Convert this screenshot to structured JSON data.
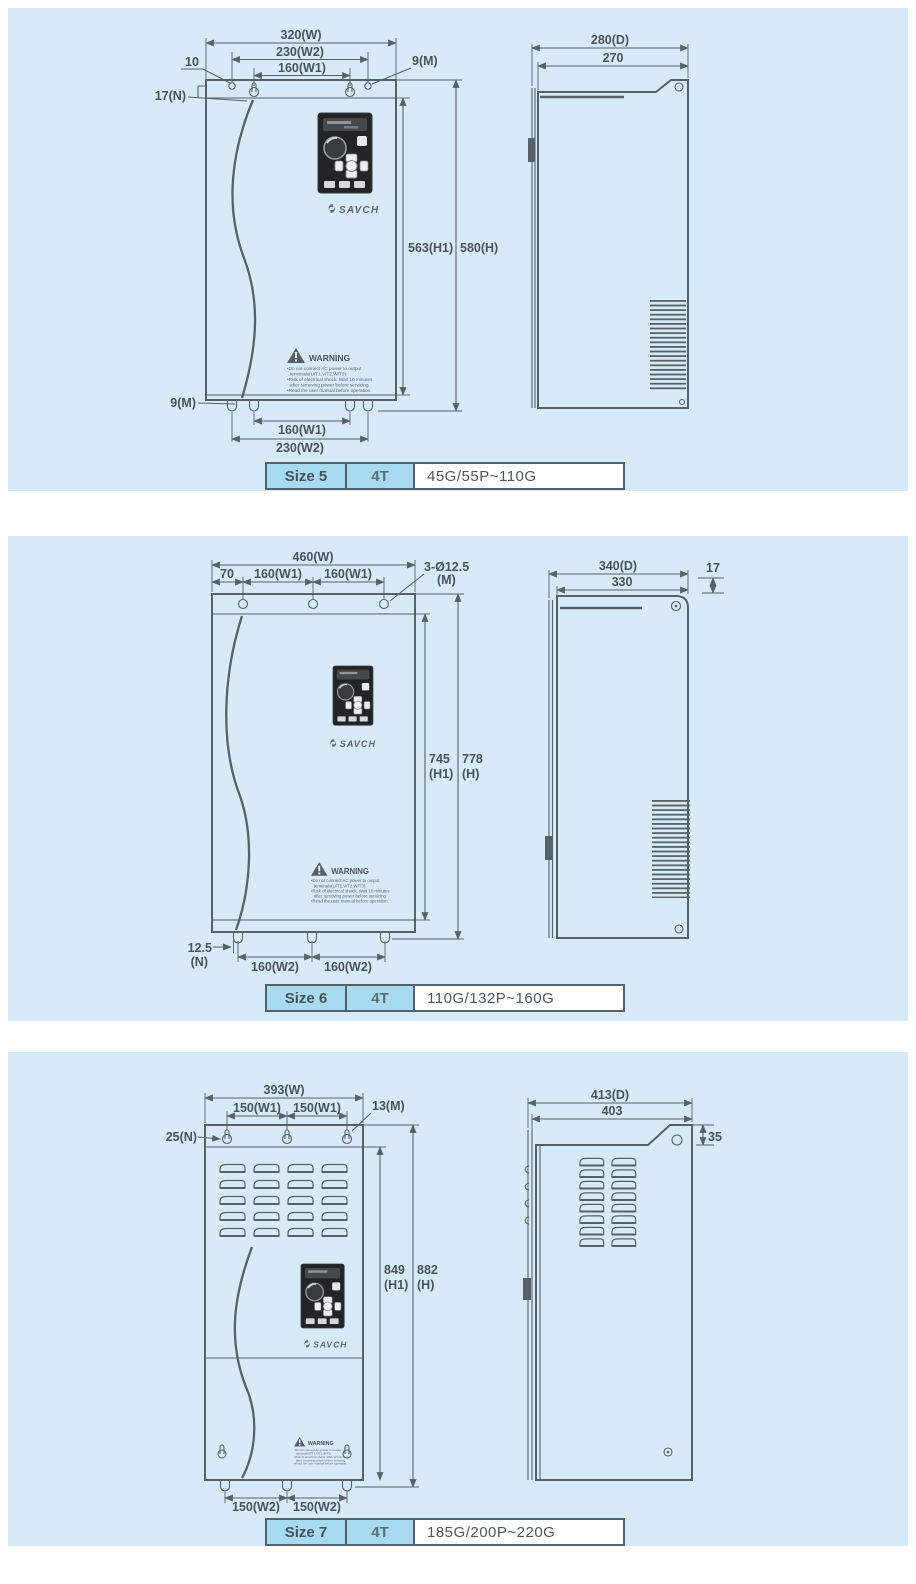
{
  "brand": "SAVCH",
  "colors": {
    "panel_bg": "#d6ebf7",
    "line": "#57616a",
    "cell_blue": "#a8daf1"
  },
  "warning": {
    "title": "WARNING",
    "lines": [
      "•Do not connect AC power to output",
      "terminals(U/T1,V/T2,W/T3).",
      "•Risk of electrical shock. Wait 10 minutes",
      "after removing power before servicing.",
      "•Read the user manual before operation."
    ]
  },
  "panels": [
    {
      "table": {
        "size": "Size 5",
        "voltage": "4T",
        "range": "45G/55P~110G"
      },
      "front": {
        "width": "320(W)",
        "w2_top": "230(W2)",
        "w1_top": "160(W1)",
        "offset_top": "10",
        "hole_top": "9(M)",
        "slot_left": "17(N)",
        "h1": "563(H1)",
        "h": "580(H)",
        "hole_bottom": "9(M)",
        "w1_bottom": "160(W1)",
        "w2_bottom": "230(W2)"
      },
      "side": {
        "depth": "280(D)",
        "depth_inner": "270"
      }
    },
    {
      "table": {
        "size": "Size 6",
        "voltage": "4T",
        "range": "110G/132P~160G"
      },
      "front": {
        "width": "460(W)",
        "offset_top": "70",
        "w1_a": "160(W1)",
        "w1_b": "160(W1)",
        "holes_1": "3-Ø12.5",
        "holes_2": "(M)",
        "h1_1": "745",
        "h1_2": "(H1)",
        "h_1": "778",
        "h_2": "(H)",
        "n_1": "12.5",
        "n_2": "(N)",
        "w2_a": "160(W2)",
        "w2_b": "160(W2)"
      },
      "side": {
        "depth": "340(D)",
        "depth_inner": "330",
        "offset": "17"
      }
    },
    {
      "table": {
        "size": "Size 7",
        "voltage": "4T",
        "range": "185G/200P~220G"
      },
      "front": {
        "width": "393(W)",
        "w1_a": "150(W1)",
        "w1_b": "150(W1)",
        "hole_top": "13(M)",
        "slot_left": "25(N)",
        "h1_1": "849",
        "h1_2": "(H1)",
        "h_1": "882",
        "h_2": "(H)",
        "w2_a": "150(W2)",
        "w2_b": "150(W2)"
      },
      "side": {
        "depth": "413(D)",
        "depth_inner": "403",
        "offset": "35"
      }
    }
  ]
}
